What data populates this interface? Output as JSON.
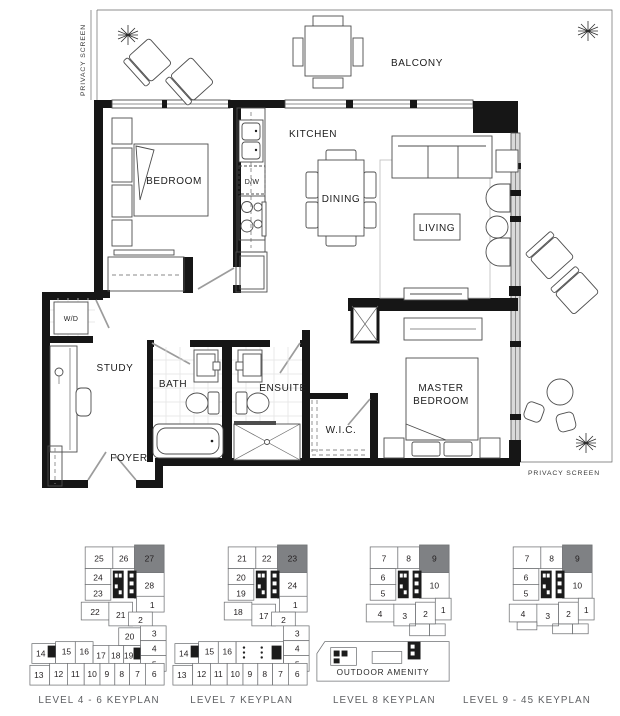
{
  "plan": {
    "rooms": {
      "bedroom": "BEDROOM",
      "kitchen": "KITCHEN",
      "dining": "DINING",
      "living": "LIVING",
      "balcony": "BALCONY",
      "study": "STUDY",
      "bath": "BATH",
      "ensuite": "ENSUITE",
      "wic": "W.I.C.",
      "foyer": "FOYER",
      "master_line1": "MASTER",
      "master_line2": "BEDROOM"
    },
    "fixtures": {
      "washer_dryer": "W/D",
      "dishwasher": "D/W"
    },
    "privacy_screen_left": "PRIVACY SCREEN",
    "privacy_screen_right": "PRIVACY SCREEN"
  },
  "colors": {
    "unit_highlight": "#7f8184",
    "wall": "#161616"
  },
  "keyplans": [
    {
      "caption": "LEVEL 4 - 6 KEYPLAN",
      "highlighted_unit": "27",
      "units": [
        "25",
        "26",
        "27",
        "24",
        "23",
        "28",
        "22",
        "21",
        "1",
        "2",
        "20",
        "3",
        "4",
        "5",
        "14",
        "15",
        "16",
        "17",
        "18",
        "19",
        "13",
        "12",
        "11",
        "10",
        "9",
        "8",
        "7",
        "6"
      ]
    },
    {
      "caption": "LEVEL 7 KEYPLAN",
      "highlighted_unit": "23",
      "units": [
        "21",
        "22",
        "23",
        "20",
        "19",
        "24",
        "18",
        "17",
        "1",
        "2",
        "3",
        "4",
        "5",
        "14",
        "15",
        "16",
        "13",
        "12",
        "11",
        "10",
        "9",
        "8",
        "7",
        "6"
      ]
    },
    {
      "caption": "LEVEL 8 KEYPLAN",
      "highlighted_unit": "9",
      "amenity_label": "OUTDOOR AMENITY",
      "units": [
        "7",
        "8",
        "9",
        "6",
        "5",
        "10",
        "4",
        "3",
        "2",
        "1"
      ]
    },
    {
      "caption": "LEVEL 9 - 45 KEYPLAN",
      "highlighted_unit": "9",
      "units": [
        "7",
        "8",
        "9",
        "6",
        "5",
        "10",
        "4",
        "3",
        "2",
        "1"
      ]
    }
  ]
}
